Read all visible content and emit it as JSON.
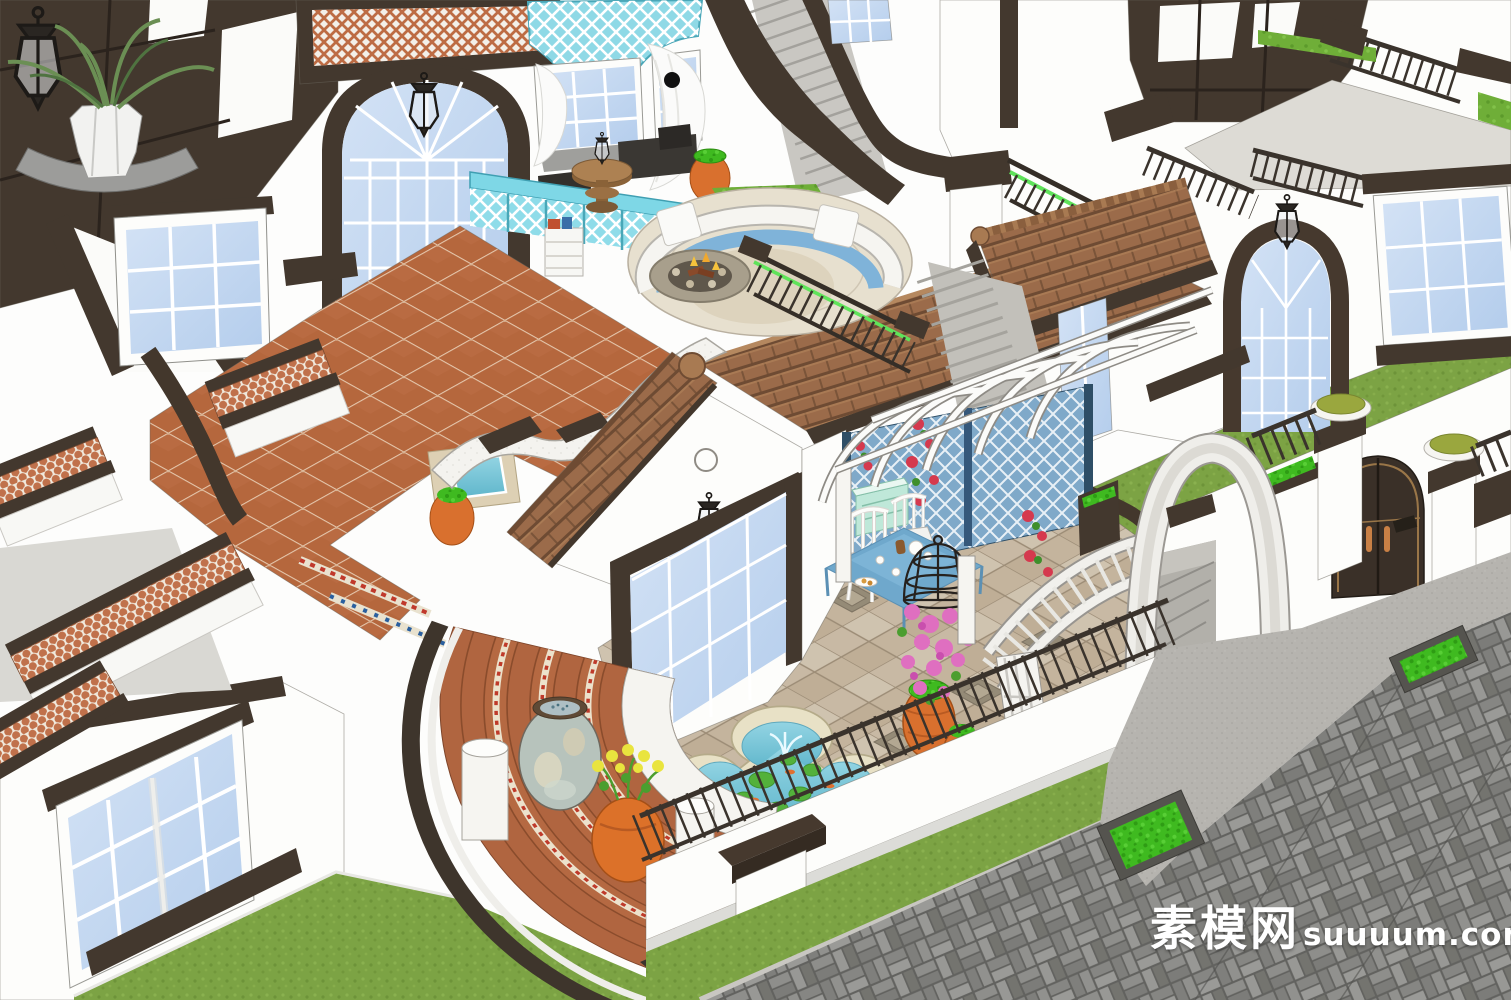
{
  "meta": {
    "title": "Mediterranean style villa courtyard - 3D architectural rendering",
    "render_style": "SketchUp-style white model with color textures"
  },
  "watermark": {
    "cjk": "素模网",
    "latin": "suuuum.com"
  },
  "palette": {
    "trim": "#43382e",
    "wall": "#fdfdfb",
    "glass": "#c3d8f0",
    "terracotta": "#b5673d",
    "grout": "#e5c8ae",
    "roof": "#9b6b4a",
    "roofDark": "#6e4b33",
    "cyan": "#7ed7e6",
    "water": "#7cc8da",
    "stone": "#c8b9a4",
    "grass": "#7ca344",
    "shrub": "#3fba20",
    "roadBrick": "#8e8e8b",
    "roadBase": "#62625f",
    "concrete": "#b6b4af",
    "pot": "#d9702e",
    "cloth": "#6fa8cc",
    "rose": "#d5394e",
    "pink": "#df6fc0",
    "mint": "#bfe8d9",
    "oliveCap": "#9aa73e",
    "greenGlow": "#5fe35a",
    "watermark": "#ffffff"
  },
  "scene": {
    "objects": [
      "timber-framed-facade",
      "wall-lantern",
      "potted-palm-on-sconce",
      "terracotta-lattice-screen",
      "arched-window",
      "lace-curtains",
      "cyan-lattice-valance",
      "window-seat-bench",
      "round-side-table",
      "sunken-lounge-sofa",
      "fire-pit",
      "terracotta-tile-terrace",
      "spa-pool",
      "wavy-parapet",
      "gable-pavilion",
      "french-doors",
      "white-pergola-vault",
      "rose-lattice-wall",
      "tea-table",
      "white-chairs",
      "birdcage-planter",
      "quatrefoil-fountain",
      "stone-tile-courtyard",
      "clay-pots",
      "curved-terracotta-stairs",
      "ceramic-urn",
      "yellow-flower-pot",
      "perimeter-wall-fence",
      "garden-gate",
      "gate-pillars",
      "white-arch",
      "lawn",
      "herringbone-road",
      "street-planters"
    ]
  }
}
